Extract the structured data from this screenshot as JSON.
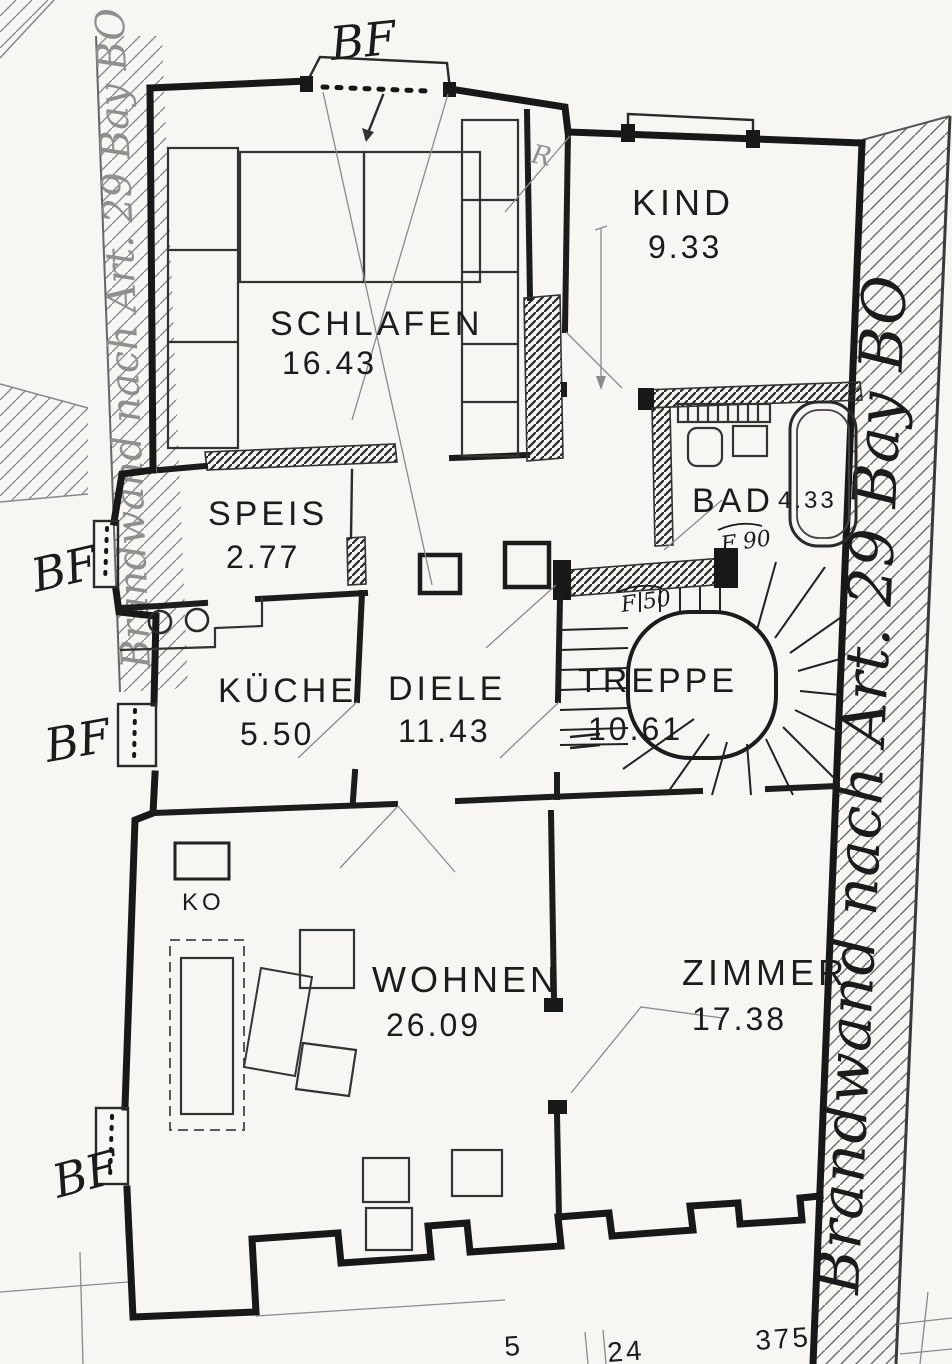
{
  "document": {
    "type": "scanned floor plan",
    "paper_color": "#f7f6f2",
    "ink_color": "#1c1c1c"
  },
  "rooms": [
    {
      "name": "SCHLAFEN",
      "area": "16.43"
    },
    {
      "name": "KIND",
      "area": "9.33"
    },
    {
      "name": "SPEIS",
      "area": "2.77"
    },
    {
      "name": "BAD",
      "area": "4.33"
    },
    {
      "name": "KÜCHE",
      "area": "5.50"
    },
    {
      "name": "DIELE",
      "area": "11.43"
    },
    {
      "name": "TREPPE",
      "area": "10.61"
    },
    {
      "name": "WOHNEN",
      "area": "26.09"
    },
    {
      "name": "ZIMMER",
      "area": "17.38"
    }
  ],
  "annotations": {
    "firewall_left": "Brandwand nach Art. 29 Bay BO",
    "firewall_right": "Brandwand nach Art. 29 Bay BO",
    "bf_top": "BF",
    "bf_left_upper": "BF",
    "bf_left_middle": "BF",
    "bf_left_lower": "BF",
    "fire_rating_bad": "F 90",
    "fire_rating_stair": "F 50",
    "cabinet_label": "KO",
    "pencil_mark": "R"
  },
  "dimensions": {
    "bottom_partial": "5",
    "bottom_center": "24",
    "bottom_right": "375"
  }
}
